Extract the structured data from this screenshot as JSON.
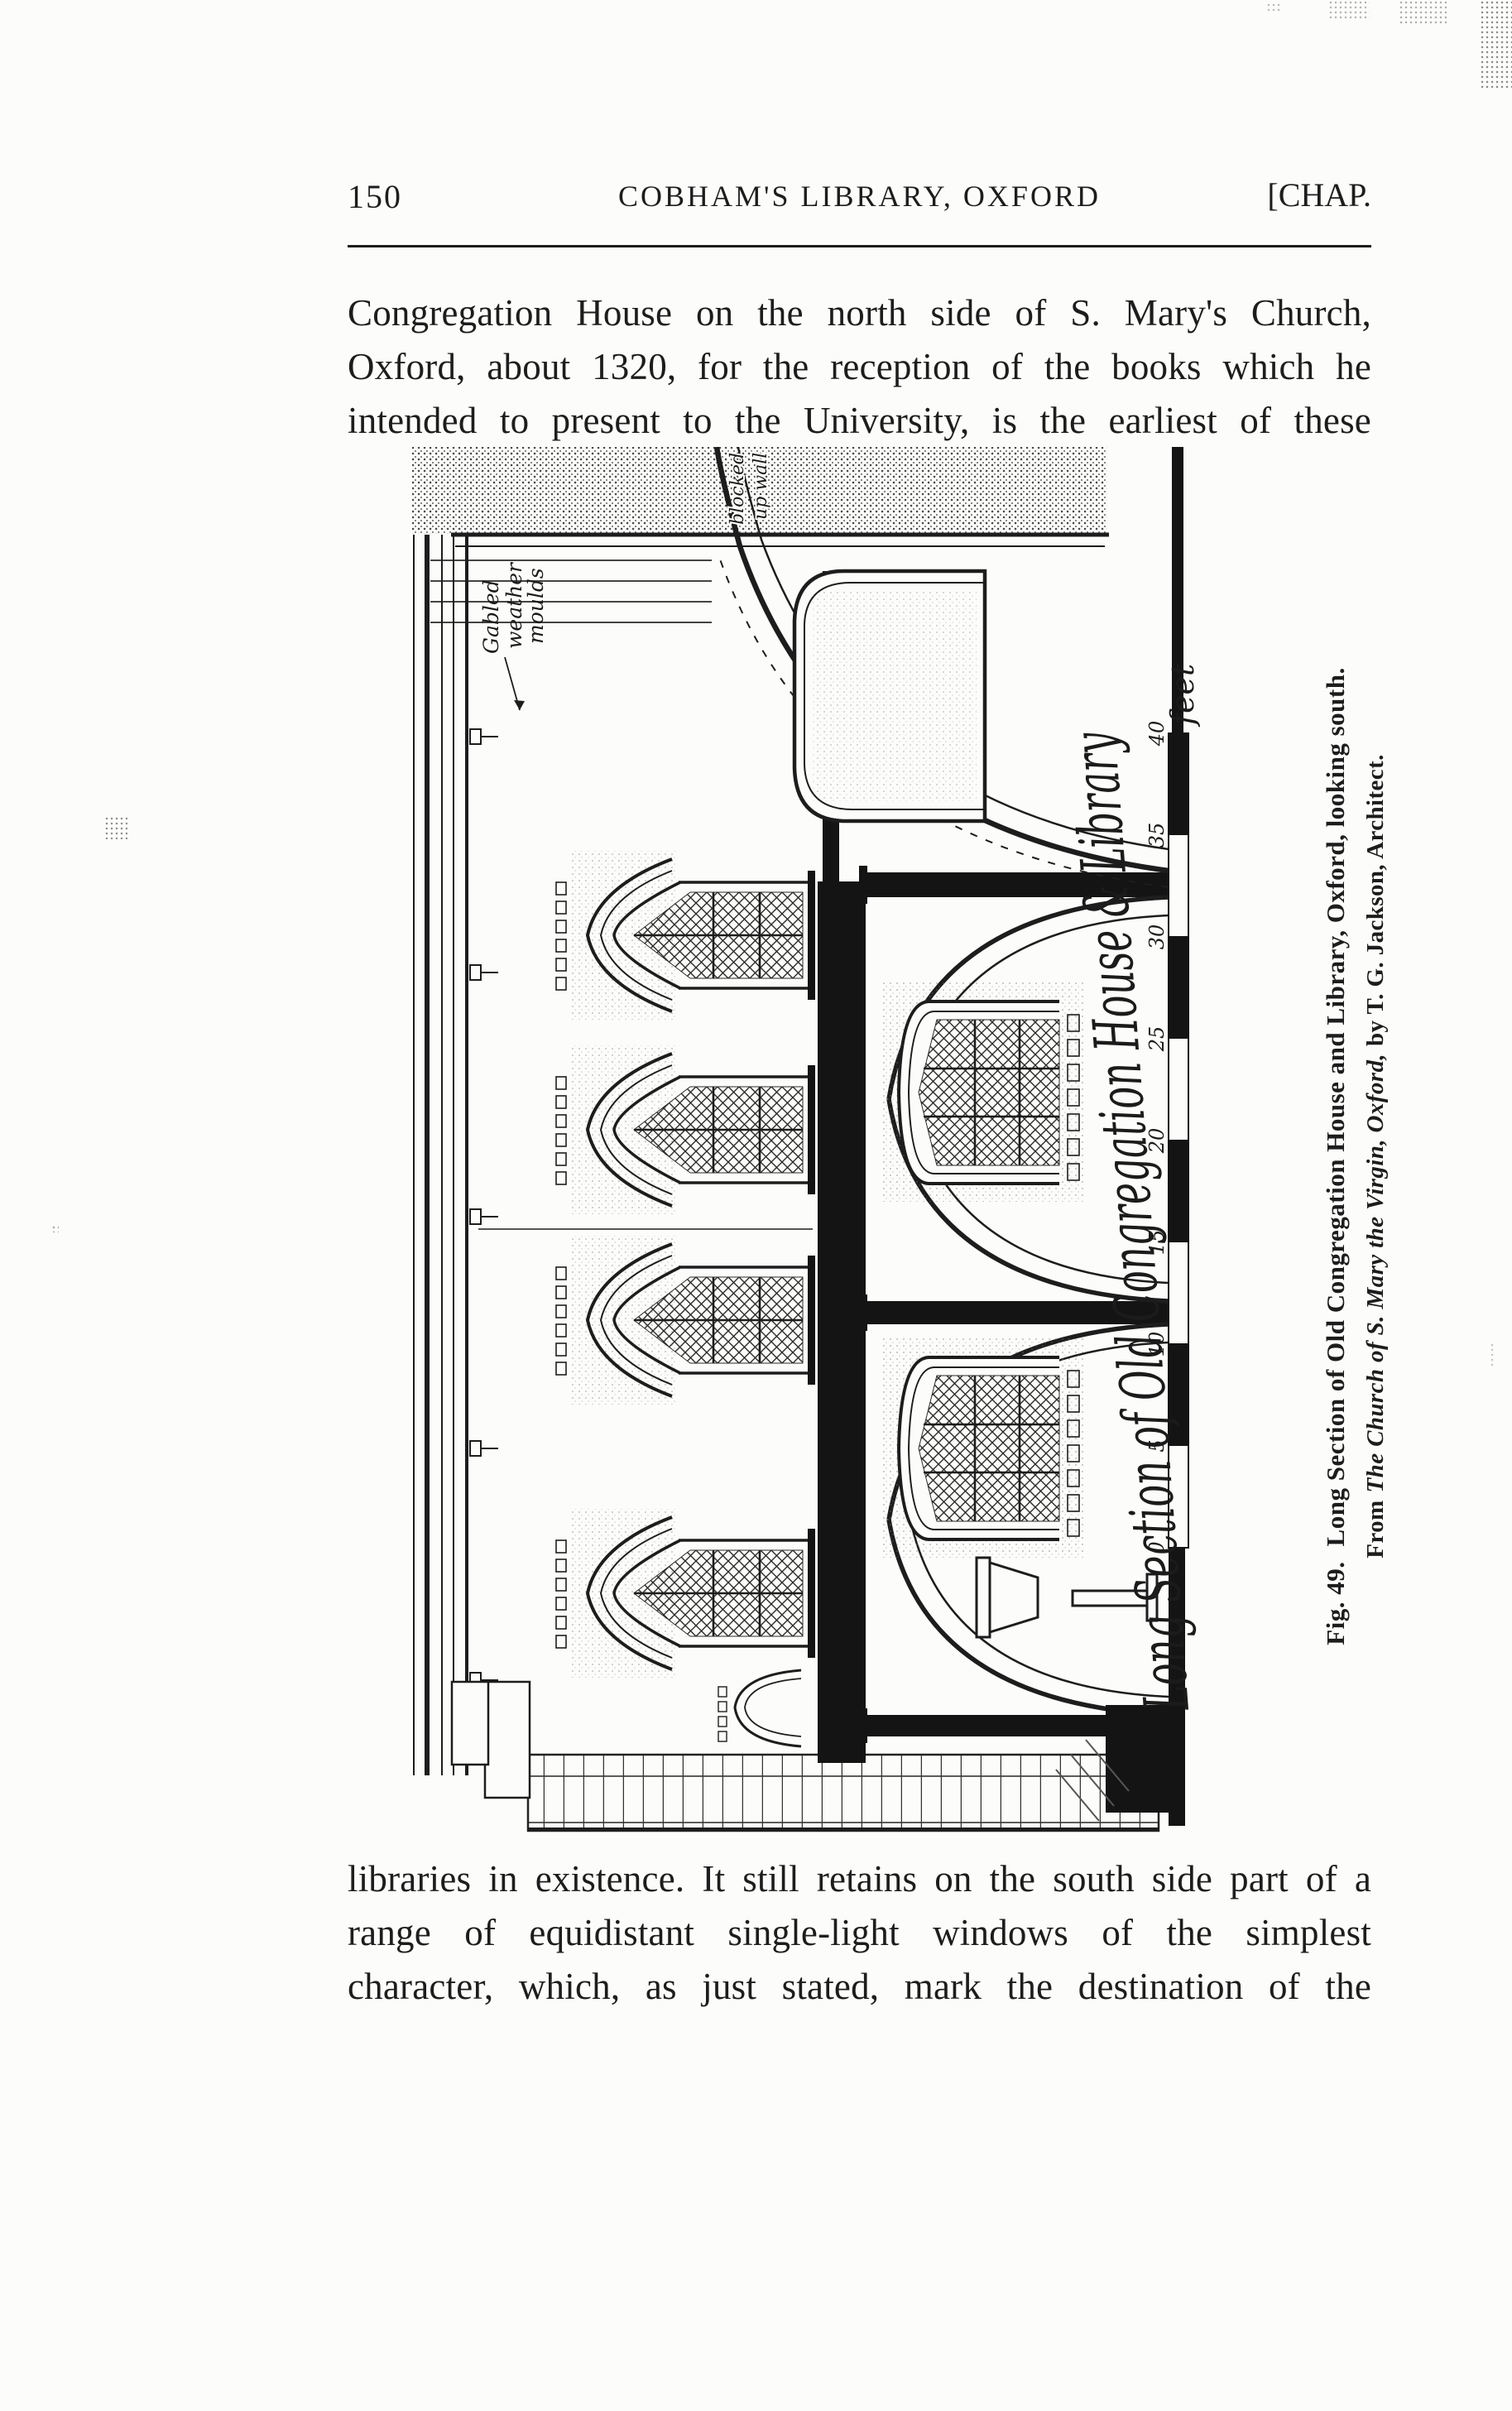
{
  "page": {
    "number": "150",
    "header_center": "COBHAM'S LIBRARY, OXFORD",
    "header_right": "[CHAP.",
    "paragraph_top": "Congregation House on the north side of S. Mary's Church, Oxford, about 1320, for the reception of the books which he intended to present to the University, is the earliest of these",
    "paragraph_bottom": "libraries in existence.  It still retains on the south side part of a range of equidistant single-light windows of the simplest character, which, as just stated, mark the destination of the"
  },
  "figure": {
    "caption": {
      "fig_label": "Fig. 49.",
      "line1": "Long Section of Old Congregation House and Library, Oxford, looking south.",
      "line2_prefix": "From",
      "line2_italic": "The Church of S. Mary the Virgin, Oxford,",
      "line2_suffix": "by T. G. Jackson, Architect."
    },
    "drawing": {
      "title": "Long Section of Old Congregation House & Library",
      "annotation_gable_1": "Gabled",
      "annotation_gable_2": "weather",
      "annotation_gable_3": "moulds",
      "annotation_wall_1": "blocked",
      "annotation_wall_2": "up wall",
      "scale_unit": "feet",
      "scale_ticks": [
        "0",
        "5",
        "10",
        "15",
        "20",
        "25",
        "30",
        "35",
        "40"
      ]
    }
  },
  "colors": {
    "paper": "#fcfcfa",
    "ink": "#1d1d1d"
  }
}
